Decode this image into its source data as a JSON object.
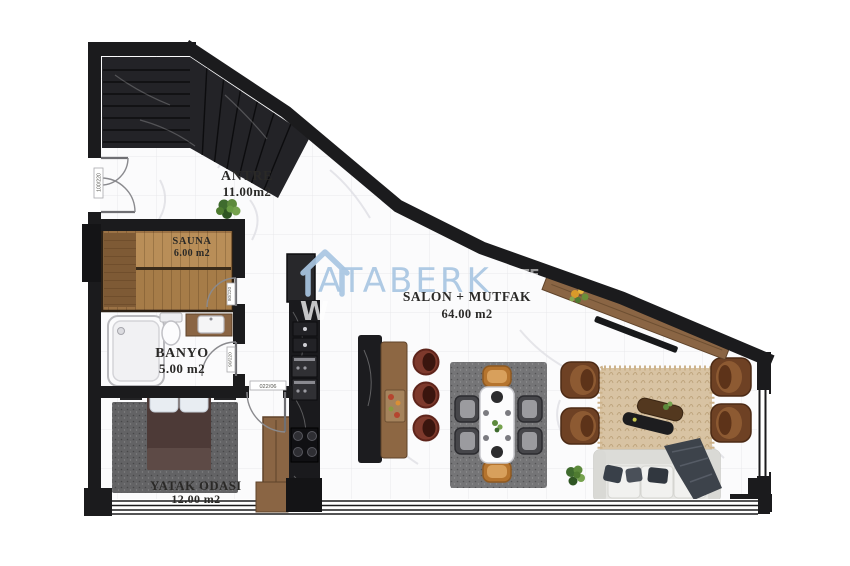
{
  "watermark": {
    "brand": "ATABERK",
    "fragment_w": "W",
    "fragment_te": "TE",
    "color": "#a9c6e2"
  },
  "rooms": [
    {
      "id": "antre",
      "name": "ANTRE",
      "area": "11.00m2"
    },
    {
      "id": "sauna",
      "name": "SAUNA",
      "area": "6.00 m2"
    },
    {
      "id": "banyo",
      "name": "BANYO",
      "area": "5.00 m2"
    },
    {
      "id": "yatak-odasi",
      "name": "YATAK ODASI",
      "area": "12.00 m2"
    },
    {
      "id": "salon-mutfak",
      "name": "SALON + MUTFAK",
      "area": "64.00 m2"
    }
  ],
  "door_labels": {
    "entrance": "100/220",
    "banyo": "90/220",
    "bedroom": "022/06",
    "sauna": "80/220"
  },
  "palette": {
    "wall": "#1b1b1d",
    "floor": "#fbfbfc",
    "tile_line": "#e8e8eb",
    "dark_marble": "#232327",
    "wood": "#8a6544",
    "sauna_wood": "#9b7245",
    "stool": "#7d392c",
    "armchair": "#6e4124",
    "sofa": "#e6e6e3",
    "rug_living": "#d8c3a3",
    "rug_gray": "#636365",
    "chair_orange": "#b5742e",
    "watermark_blue": "#a9c6e2"
  }
}
